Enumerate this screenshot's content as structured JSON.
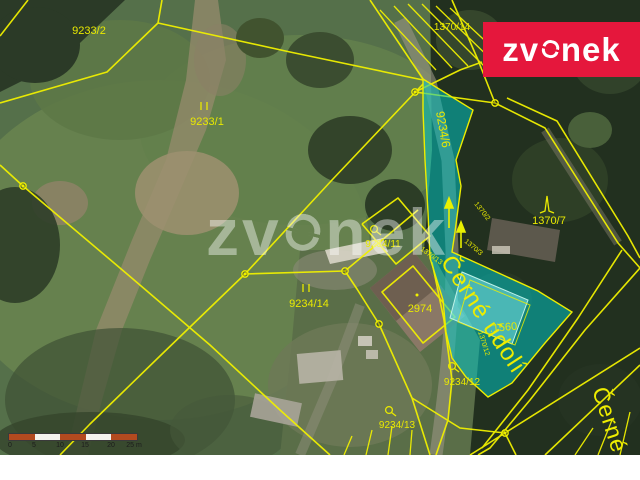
{
  "branding": {
    "brand_red": "#e5173c",
    "logo_text_left": "zv",
    "logo_text_right": "nek",
    "watermark_text_left": "zv",
    "watermark_text_right": "nek"
  },
  "map": {
    "highlight_color": "#00c9c9",
    "line_color": "#f0f000",
    "parcels": [
      {
        "id": "9233-2",
        "text": "9233/2"
      },
      {
        "id": "9233-1",
        "text": "9233/1"
      },
      {
        "id": "1370-14",
        "text": "1370/14"
      },
      {
        "id": "9234-6",
        "text": "9234/6"
      },
      {
        "id": "1370-7",
        "text": "1370/7"
      },
      {
        "id": "9234-11",
        "text": "9234/11"
      },
      {
        "id": "9234-14",
        "text": "9234/14"
      },
      {
        "id": "2974",
        "text": "2974"
      },
      {
        "id": "1560",
        "text": ".1560"
      },
      {
        "id": "9234-12",
        "text": "9234/12"
      },
      {
        "id": "9234-13",
        "text": "9234/13"
      },
      {
        "id": "1370-2",
        "text": "1370/2"
      },
      {
        "id": "1370-3",
        "text": "1370/3"
      },
      {
        "id": "1370-13",
        "text": "1370/13"
      },
      {
        "id": "1370-12",
        "text": "1370/12"
      }
    ],
    "streets": [
      {
        "text": "Černé údolí"
      },
      {
        "text": "Černé"
      }
    ],
    "scalebar": {
      "labels": [
        "0",
        "5",
        "10",
        "15",
        "20",
        "25 m"
      ]
    }
  }
}
